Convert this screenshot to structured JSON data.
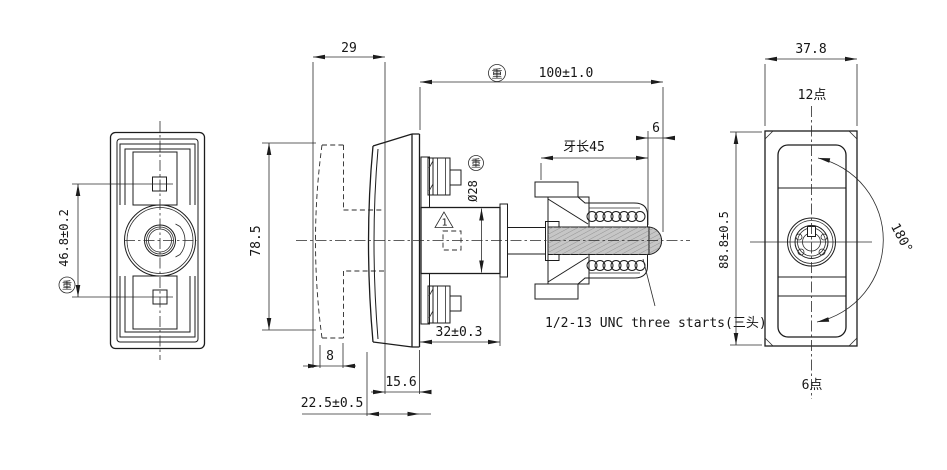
{
  "drawing_type": "engineering-drawing-3-views",
  "symbols": {
    "important": "重"
  },
  "views": {
    "front": {
      "dims": {
        "hole_spacing": "46.8±0.2",
        "height": "78.5"
      }
    },
    "side": {
      "dims": {
        "knob_width": "29",
        "overall_length": "100±1.0",
        "tip_length": "6",
        "thread_length": "牙长45",
        "boss_diameter": "Ø28",
        "boss_length": "32±0.3",
        "step": "8",
        "neck": "15.6",
        "grip_range": "22.5±0.5"
      },
      "notes": {
        "flag": "1",
        "thread_spec": "1/2-13 UNC three starts(三头)"
      }
    },
    "rear": {
      "dims": {
        "width": "37.8",
        "height": "88.8±0.5",
        "rotation": "180°"
      },
      "labels": {
        "clock_12": "12点",
        "clock_6": "6点"
      }
    }
  }
}
